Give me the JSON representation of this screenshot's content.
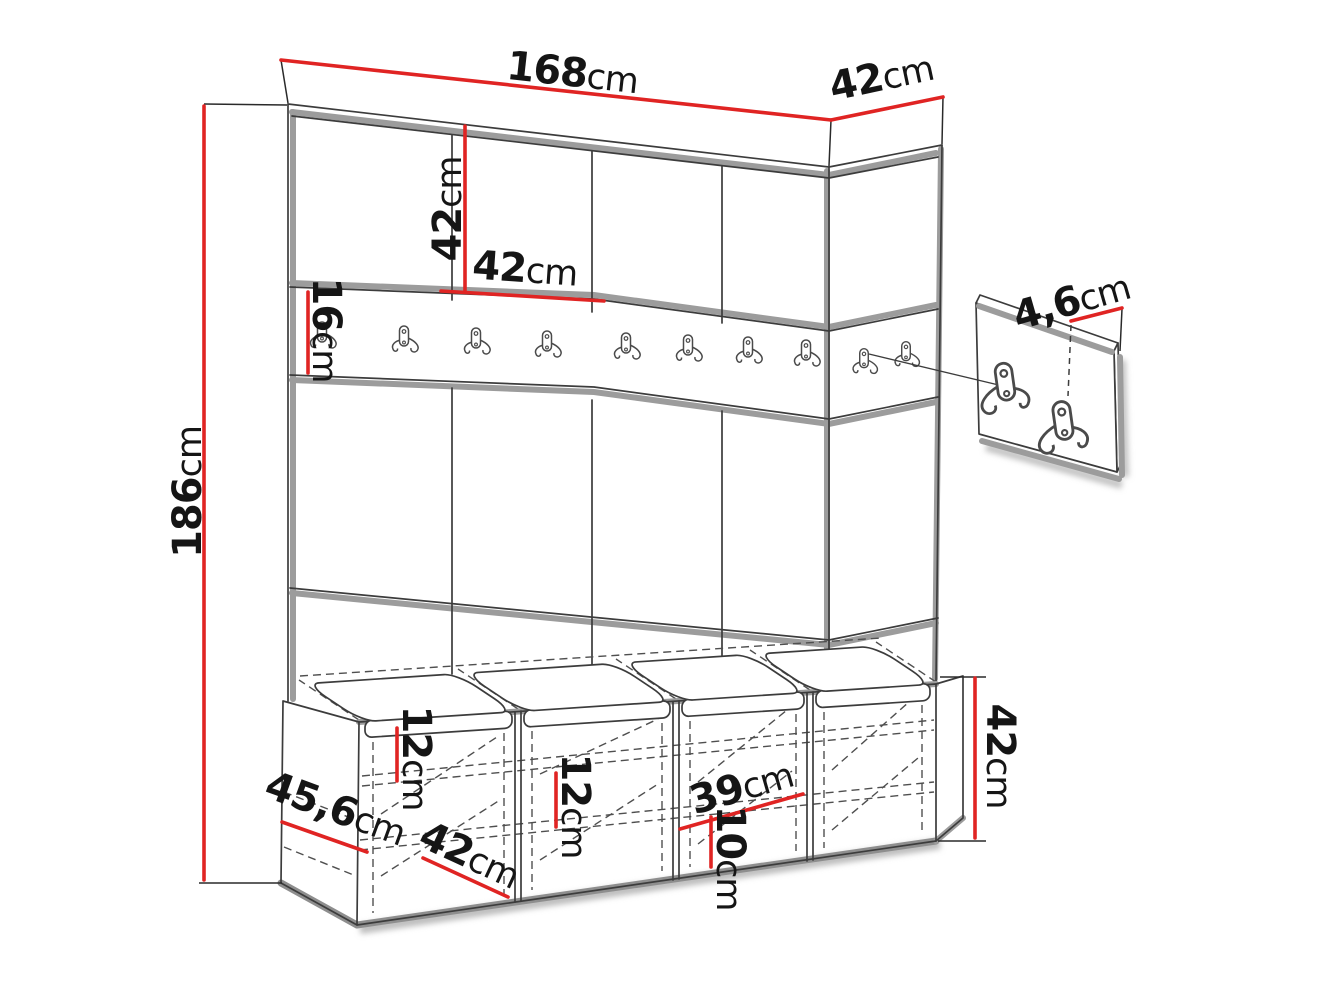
{
  "diagram": {
    "description": "Hallway furniture set dimension drawing: upholstered panel wall (4x42cm columns) with 16cm hook rail, wall-hook detail panel, and 4-compartment storage bench with seat cushions",
    "colors": {
      "dimension_red": "#e02423",
      "outline_dark": "#3c3c3c",
      "shadow_gray": "#9c9c9c",
      "background": "#ffffff"
    },
    "counts": {
      "wall_panel_columns": 4,
      "rail_hooks": 10,
      "detail_panel_hooks": 2,
      "bench_cushions": 4,
      "bench_compartments": 4
    },
    "labels": {
      "width_total": {
        "value": "168",
        "unit": "cm"
      },
      "depth_top": {
        "value": "42",
        "unit": "cm"
      },
      "height_total": {
        "value": "186",
        "unit": "cm"
      },
      "panel_height": {
        "value": "42",
        "unit": "cm"
      },
      "panel_width": {
        "value": "42",
        "unit": "cm"
      },
      "rail_height": {
        "value": "16",
        "unit": "cm"
      },
      "hook_plate_depth": {
        "value": "4,6",
        "unit": "cm"
      },
      "shelf_gap_upper": {
        "value": "12",
        "unit": "cm"
      },
      "shelf_gap_mid": {
        "value": "12",
        "unit": "cm"
      },
      "compartment_inner_width": {
        "value": "39",
        "unit": "cm"
      },
      "shelf_gap_low": {
        "value": "10",
        "unit": "cm"
      },
      "bench_height": {
        "value": "42",
        "unit": "cm"
      },
      "bench_depth": {
        "value": "45,6",
        "unit": "cm"
      },
      "bench_compartment_width": {
        "value": "42",
        "unit": "cm"
      }
    },
    "icons": {
      "rail_hook": "double-coat-hook",
      "detail_hook": "double-coat-hook-large"
    }
  }
}
